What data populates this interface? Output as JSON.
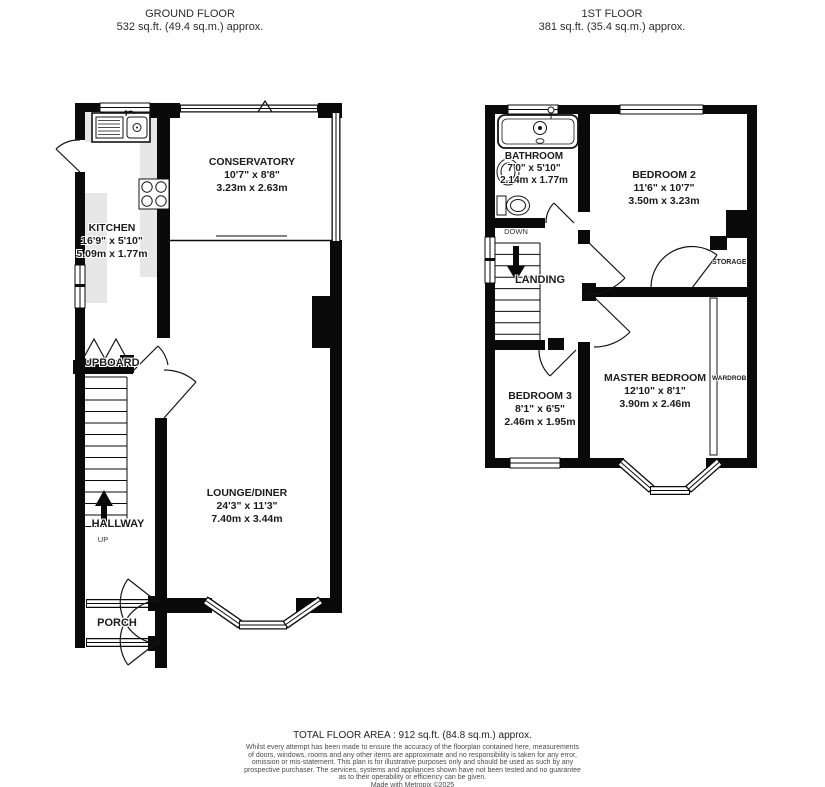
{
  "headers": {
    "ground": {
      "title": "GROUND FLOOR",
      "area": "532 sq.ft. (49.4 sq.m.) approx."
    },
    "first": {
      "title": "1ST FLOOR",
      "area": "381 sq.ft. (35.4 sq.m.) approx."
    }
  },
  "ground_floor": {
    "conservatory": {
      "name": "CONSERVATORY",
      "imperial": "10'7\" x 8'8\"",
      "metric": "3.23m x 2.63m"
    },
    "kitchen": {
      "name": "KITCHEN",
      "imperial": "16'9\" x 5'10\"",
      "metric": "5.09m x 1.77m"
    },
    "lounge": {
      "name": "LOUNGE/DINER",
      "imperial": "24'3\" x 11'3\"",
      "metric": "7.40m x 3.44m"
    },
    "cupboard": "CUPBOARD",
    "hallway": "HALLWAY",
    "up": "UP",
    "porch": "PORCH"
  },
  "first_floor": {
    "bathroom": {
      "name": "BATHROOM",
      "imperial": "7'0\" x 5'10\"",
      "metric": "2.14m x 1.77m"
    },
    "bedroom2": {
      "name": "BEDROOM 2",
      "imperial": "11'6\" x 10'7\"",
      "metric": "3.50m x 3.23m"
    },
    "bedroom3": {
      "name": "BEDROOM 3",
      "imperial": "8'1\" x 6'5\"",
      "metric": "2.46m x 1.95m"
    },
    "master": {
      "name": "MASTER BEDROOM",
      "imperial": "12'10\" x 8'1\"",
      "metric": "3.90m x 2.46m"
    },
    "down": "DOWN",
    "landing": "LANDING",
    "storage": "STORAGE",
    "wardrobe": "WARDROBE"
  },
  "footer": {
    "total": "TOTAL FLOOR AREA : 912 sq.ft. (84.8 sq.m.) approx.",
    "lines": [
      "Whilst every attempt has been made to ensure the accuracy of the floorplan contained here, measurements",
      "of doors, windows, rooms and any other items are approximate and no responsibility is taken for any error,",
      "omission or mis-statement. This plan is for illustrative purposes only and should be used as such by any",
      "prospective purchaser. The services, systems and appliances shown have not been tested and no guarantee",
      "as to their operability or efficiency can be given.",
      "Made with Metropix ©2025"
    ]
  },
  "colors": {
    "wall": "#0a0a0a",
    "counter": "#e7e7e7"
  }
}
